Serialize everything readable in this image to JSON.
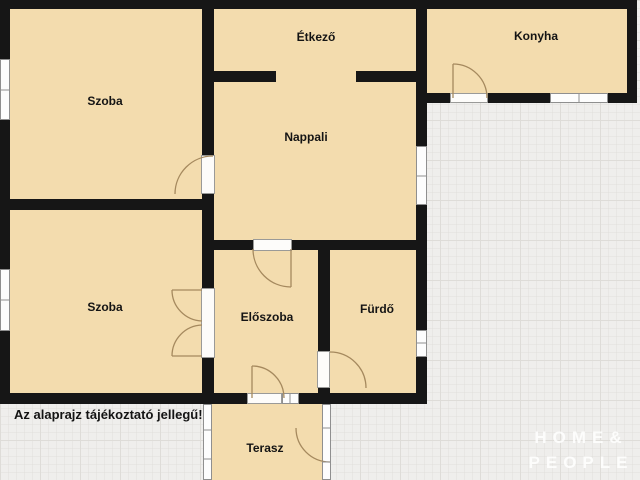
{
  "plan": {
    "labels": {
      "szoba_top": "Szoba",
      "etkezo": "Étkező",
      "konyha": "Konyha",
      "nappali": "Nappali",
      "szoba_bottom": "Szoba",
      "eloszoba": "Előszoba",
      "furdo": "Fürdő",
      "terasz": "Terasz"
    },
    "disclaimer": "Az alaprajz tájékoztató jellegű!",
    "watermark": {
      "line1": "HOME&",
      "line2": "PEOPLE"
    },
    "colors": {
      "floor": "#f3dcae",
      "wall": "#161616",
      "outside_background": "#efeeec",
      "grid_line": "#dedcd8",
      "window_fill": "#fdfdfd",
      "window_frame": "#8f8f8f",
      "door_swing_arc": "#a5895e",
      "label_text": "#141414",
      "watermark_text": "#ffffff"
    }
  }
}
